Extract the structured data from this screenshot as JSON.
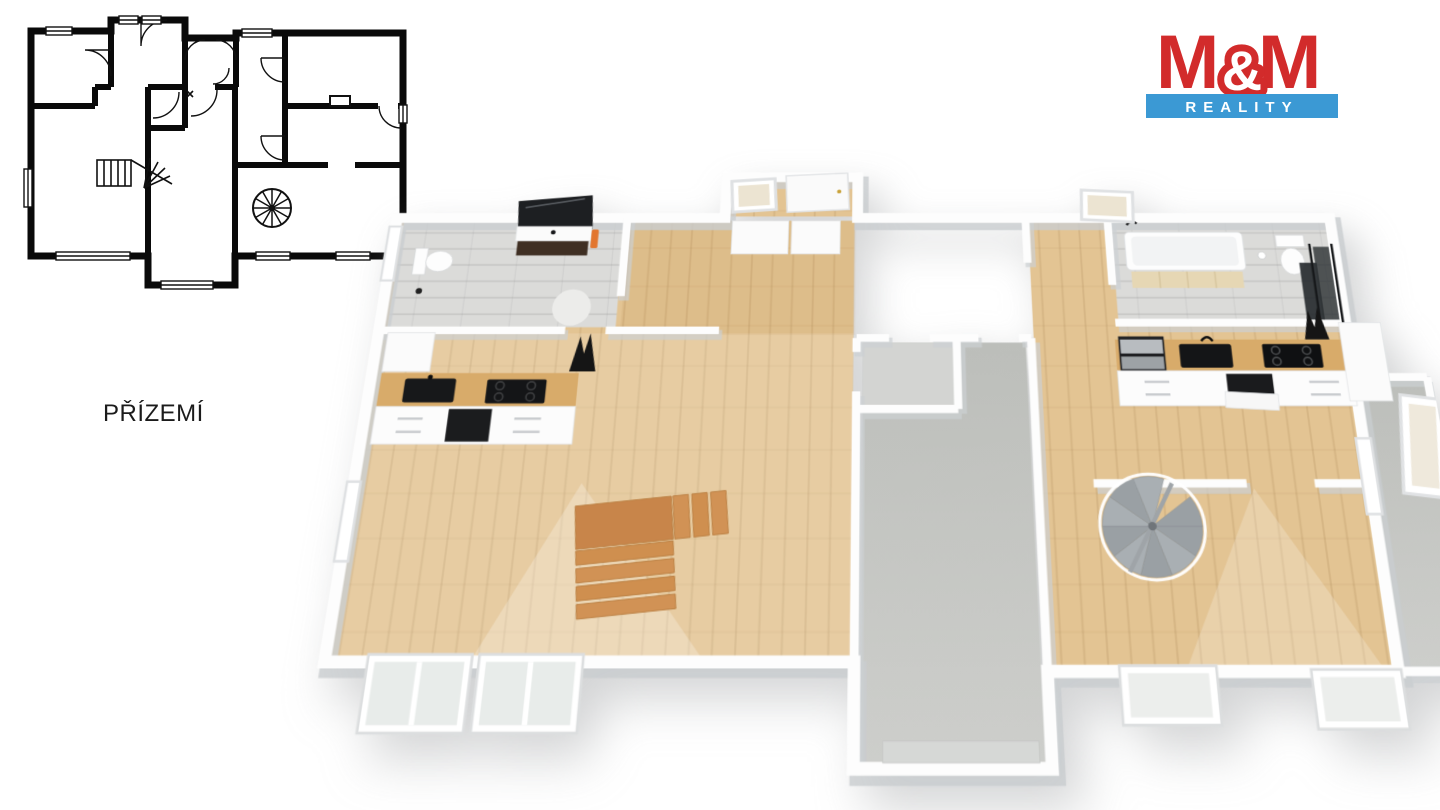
{
  "page": {
    "background": "#ffffff"
  },
  "floor": {
    "label": "PŘÍZEMÍ"
  },
  "logo": {
    "m_left": "M",
    "ampersand": "&",
    "m_right": "M",
    "banner": "REALITY",
    "red": "#d22b2b",
    "blue": "#3b99d4",
    "text_white": "#ffffff"
  },
  "plan3d_colors": {
    "wall": "#fdfdfd",
    "wall_shadow": "#c9cdd0",
    "wood_floor": "#e3c493",
    "wood_floor_light": "#ead7ab",
    "stairs_wood": "#cf8f4f",
    "tile_gray": "#dbdbd9",
    "concrete_gray": "#c6c8c4",
    "counter_wood": "#d8ab6a",
    "appliance_black": "#141517",
    "vanity_dark": "#3f2f23",
    "spiral_gray": "#9ba1a5",
    "towel_orange": "#e2762f",
    "plan2d_ink": "#0a0a0a"
  }
}
